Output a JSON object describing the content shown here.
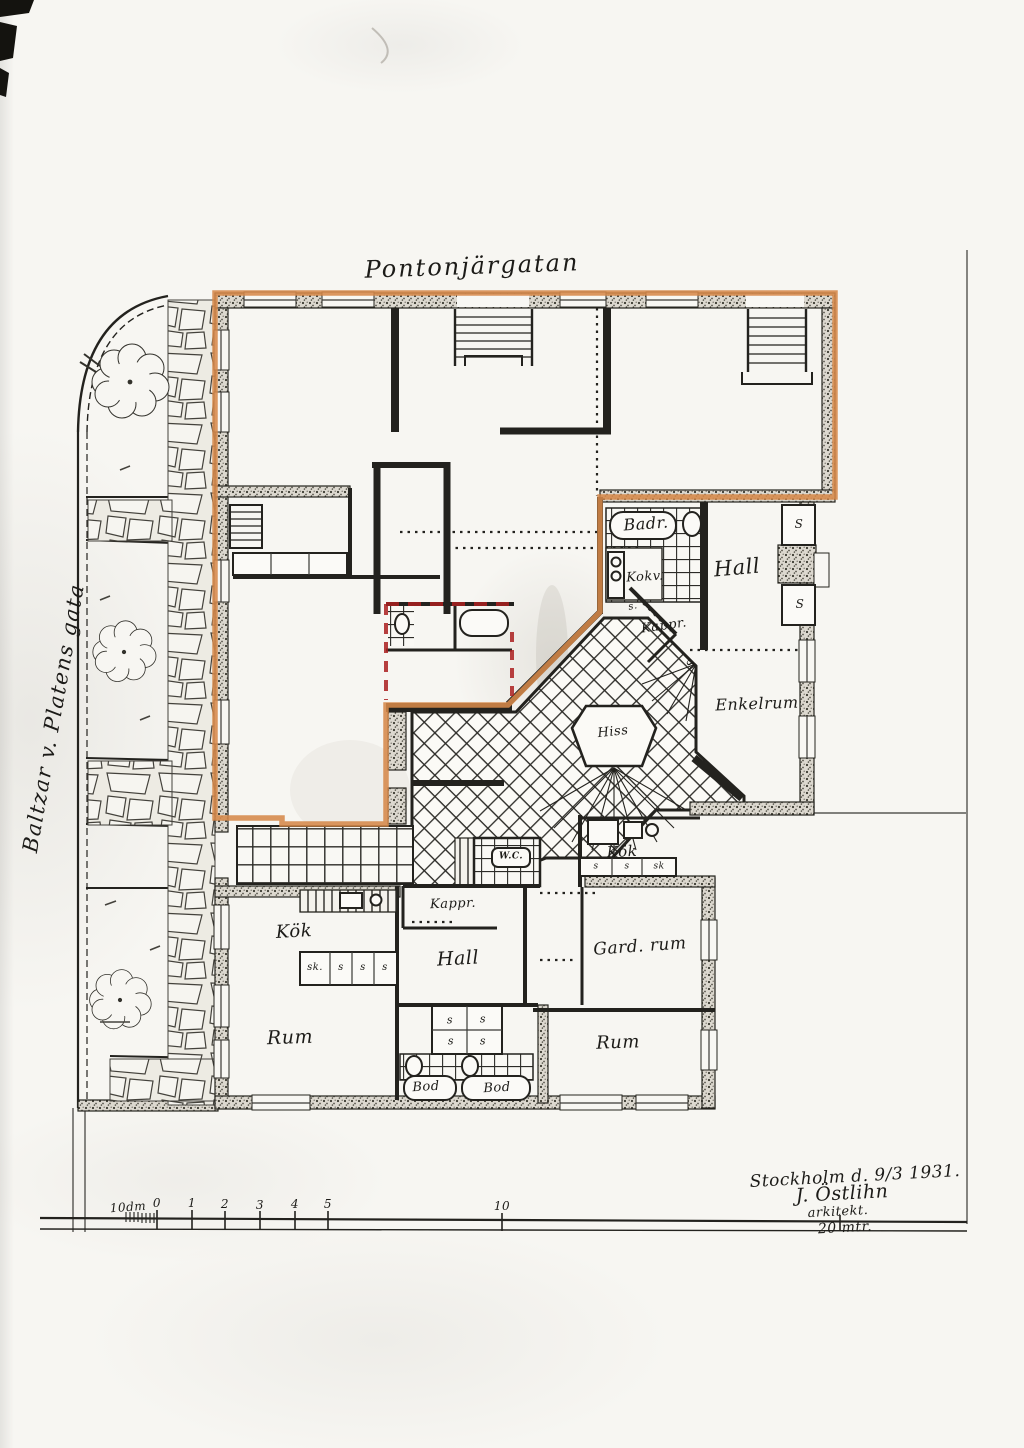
{
  "streets": {
    "top": "Pontonjärgatan",
    "left": "Baltzar v. Platens gata"
  },
  "rooms": {
    "badr": "Badr.",
    "kokv": "Kokv.",
    "hall_upper": "Hall",
    "kappr_upper": "Kappr.",
    "enkelrum": "Enkelrum",
    "hiss": "Hiss",
    "wc": "W.C.",
    "kappr_lower": "Kappr.",
    "kok_left": "Kök",
    "hall_lower": "Hall",
    "rum_left": "Rum",
    "kok_right": "Kök",
    "gard_rum": "Gard. rum",
    "rum_right": "Rum",
    "bod": "Bod"
  },
  "closets": {
    "s_cap": "S",
    "s_small": "s.",
    "s": "s",
    "sk_dot": "sk.",
    "sk": "sk"
  },
  "scale_bar": {
    "labels": [
      "10dm",
      "0",
      "1",
      "2",
      "3",
      "4",
      "5",
      "10"
    ],
    "end_label": "20 mtr."
  },
  "signature": {
    "place_date": "Stockholm d. 9/3 1931.",
    "name": "J. Östlihn",
    "title": "arkitekt."
  },
  "highlight": {
    "apartment_outline_color": "#d6894a",
    "secondary_outline_color": "#ab2020"
  }
}
